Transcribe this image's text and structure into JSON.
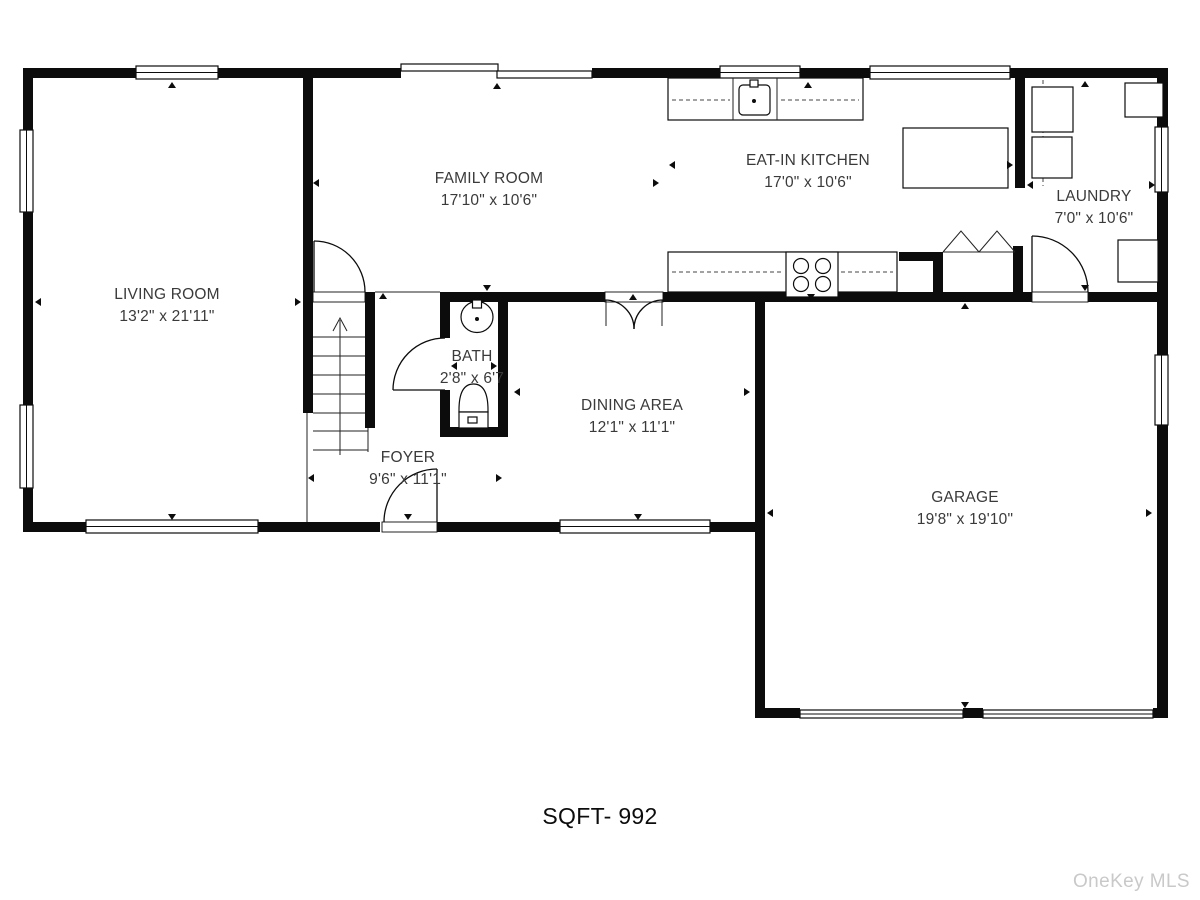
{
  "plan": {
    "rooms": [
      {
        "id": "living",
        "name": "LIVING ROOM",
        "dims": "13'2\" x 21'11\""
      },
      {
        "id": "family",
        "name": "FAMILY ROOM",
        "dims": "17'10\" x 10'6\""
      },
      {
        "id": "kitchen",
        "name": "EAT-IN KITCHEN",
        "dims": "17'0\" x 10'6\""
      },
      {
        "id": "laundry",
        "name": "LAUNDRY",
        "dims": "7'0\" x 10'6\""
      },
      {
        "id": "bath",
        "name": "BATH",
        "dims": "2'8\" x 6'7"
      },
      {
        "id": "dining",
        "name": "DINING AREA",
        "dims": "12'1\" x 11'1\""
      },
      {
        "id": "foyer",
        "name": "FOYER",
        "dims": "9'6\" x 11'1\""
      },
      {
        "id": "garage",
        "name": "GARAGE",
        "dims": "19'8\" x 19'10\""
      }
    ],
    "total_area_label": "SQFT- 992",
    "watermark": "OneKey MLS",
    "colors": {
      "wall": "#0c0c0c",
      "label_text": "#3a3a3a",
      "watermark_text": "#c9c9c9"
    }
  }
}
